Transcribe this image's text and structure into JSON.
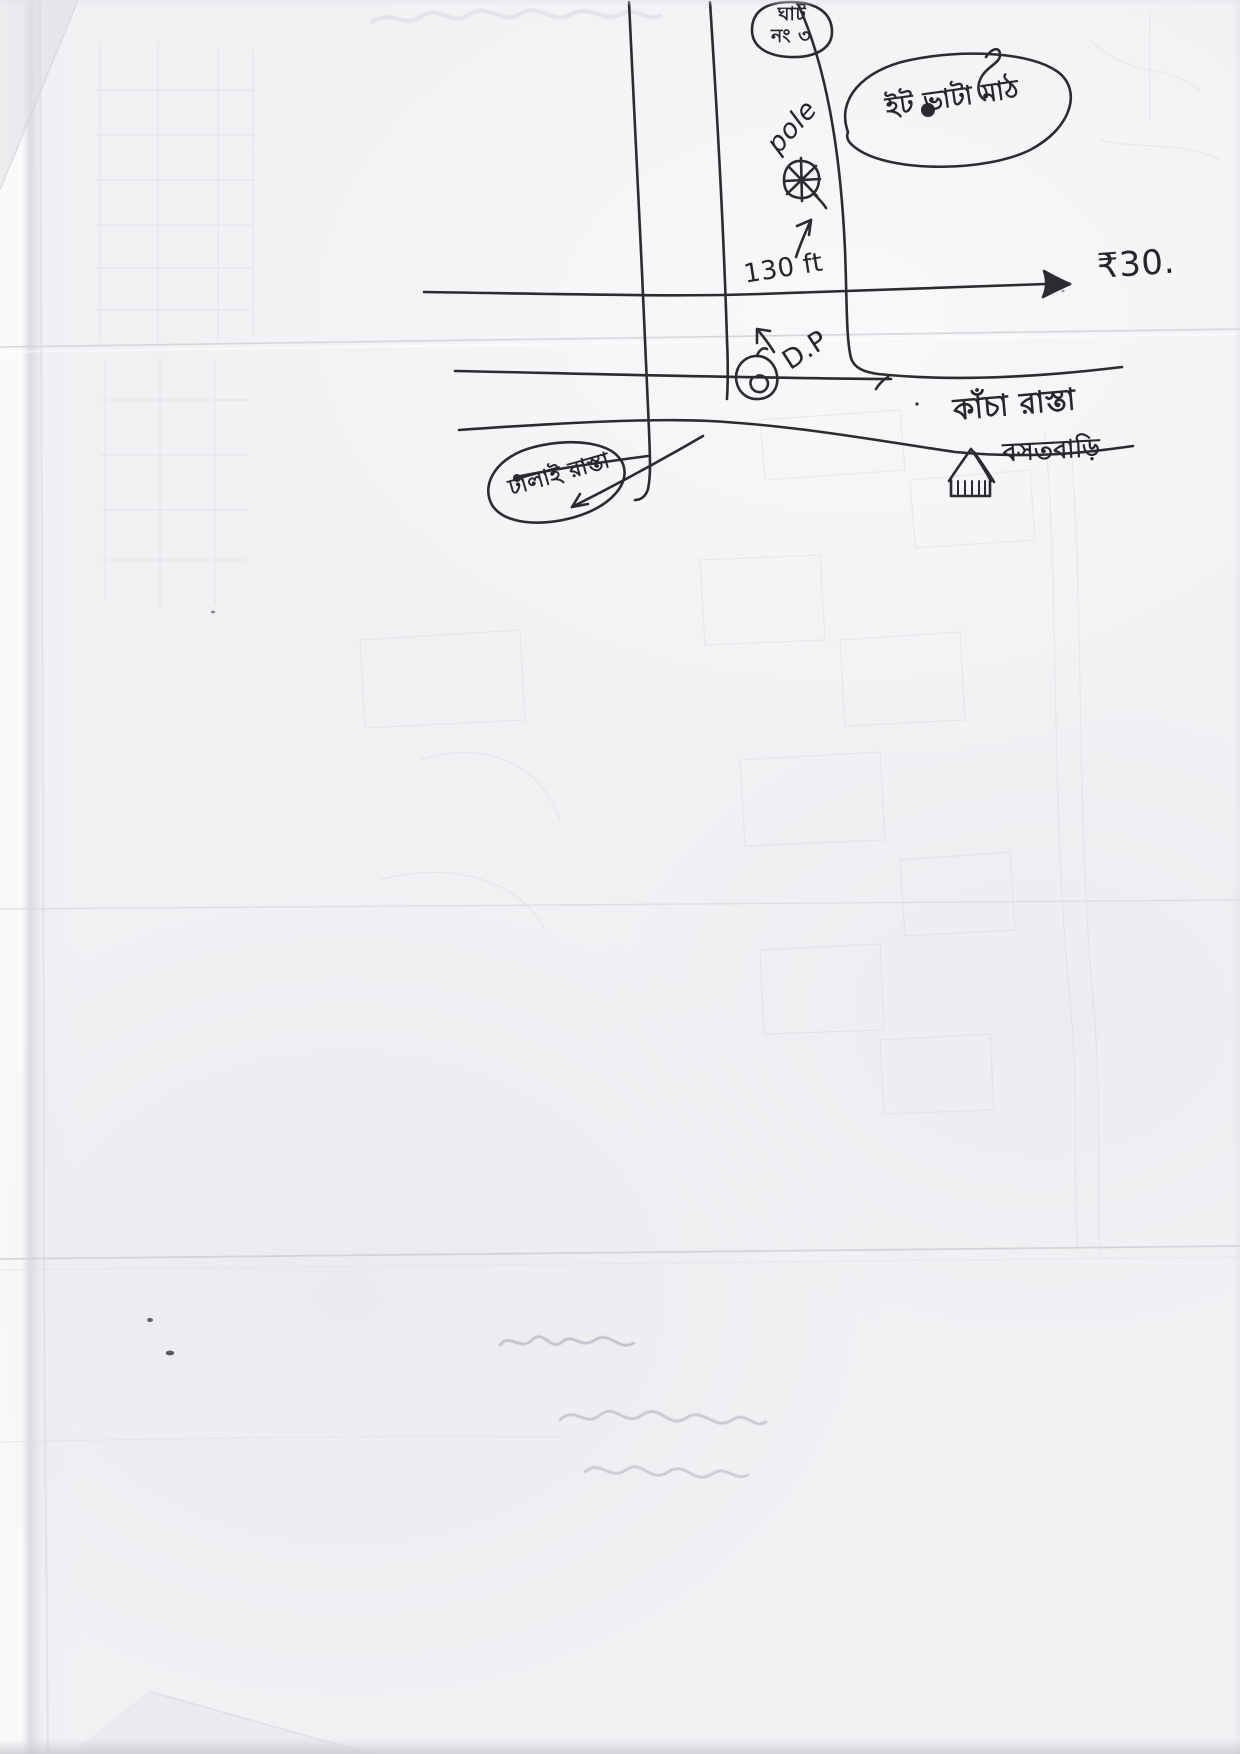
{
  "document": {
    "kind": "scanned hand-drawn sketch map on crumpled paper",
    "paper_color": "#f1f1f4",
    "ink_color": "#2b2b30"
  },
  "labels": {
    "top_circle": {
      "line1": "ঘাট",
      "line2": "নং ৩"
    },
    "pole": "pole",
    "distance": "130 ft",
    "rate": "₹30.",
    "dp": "D.P",
    "kacha_road": "কাঁচা রাস্তা",
    "field": "ইট ভাটা মাঠ",
    "paved_road": "ঢালাই রাস্তা",
    "house": "বসতবাড়ি"
  },
  "symbols": {
    "pole_symbol": "circled asterisk (electric pole)",
    "dp_symbol": "small circle with inner ring (distribution pole)",
    "house_symbol": "hut with hatched wall",
    "east_arrow": "open arrowhead pointing east",
    "up_arrow": "short arrow pointing up",
    "oval_arrow": "arrow pointing to paved-road oval"
  }
}
